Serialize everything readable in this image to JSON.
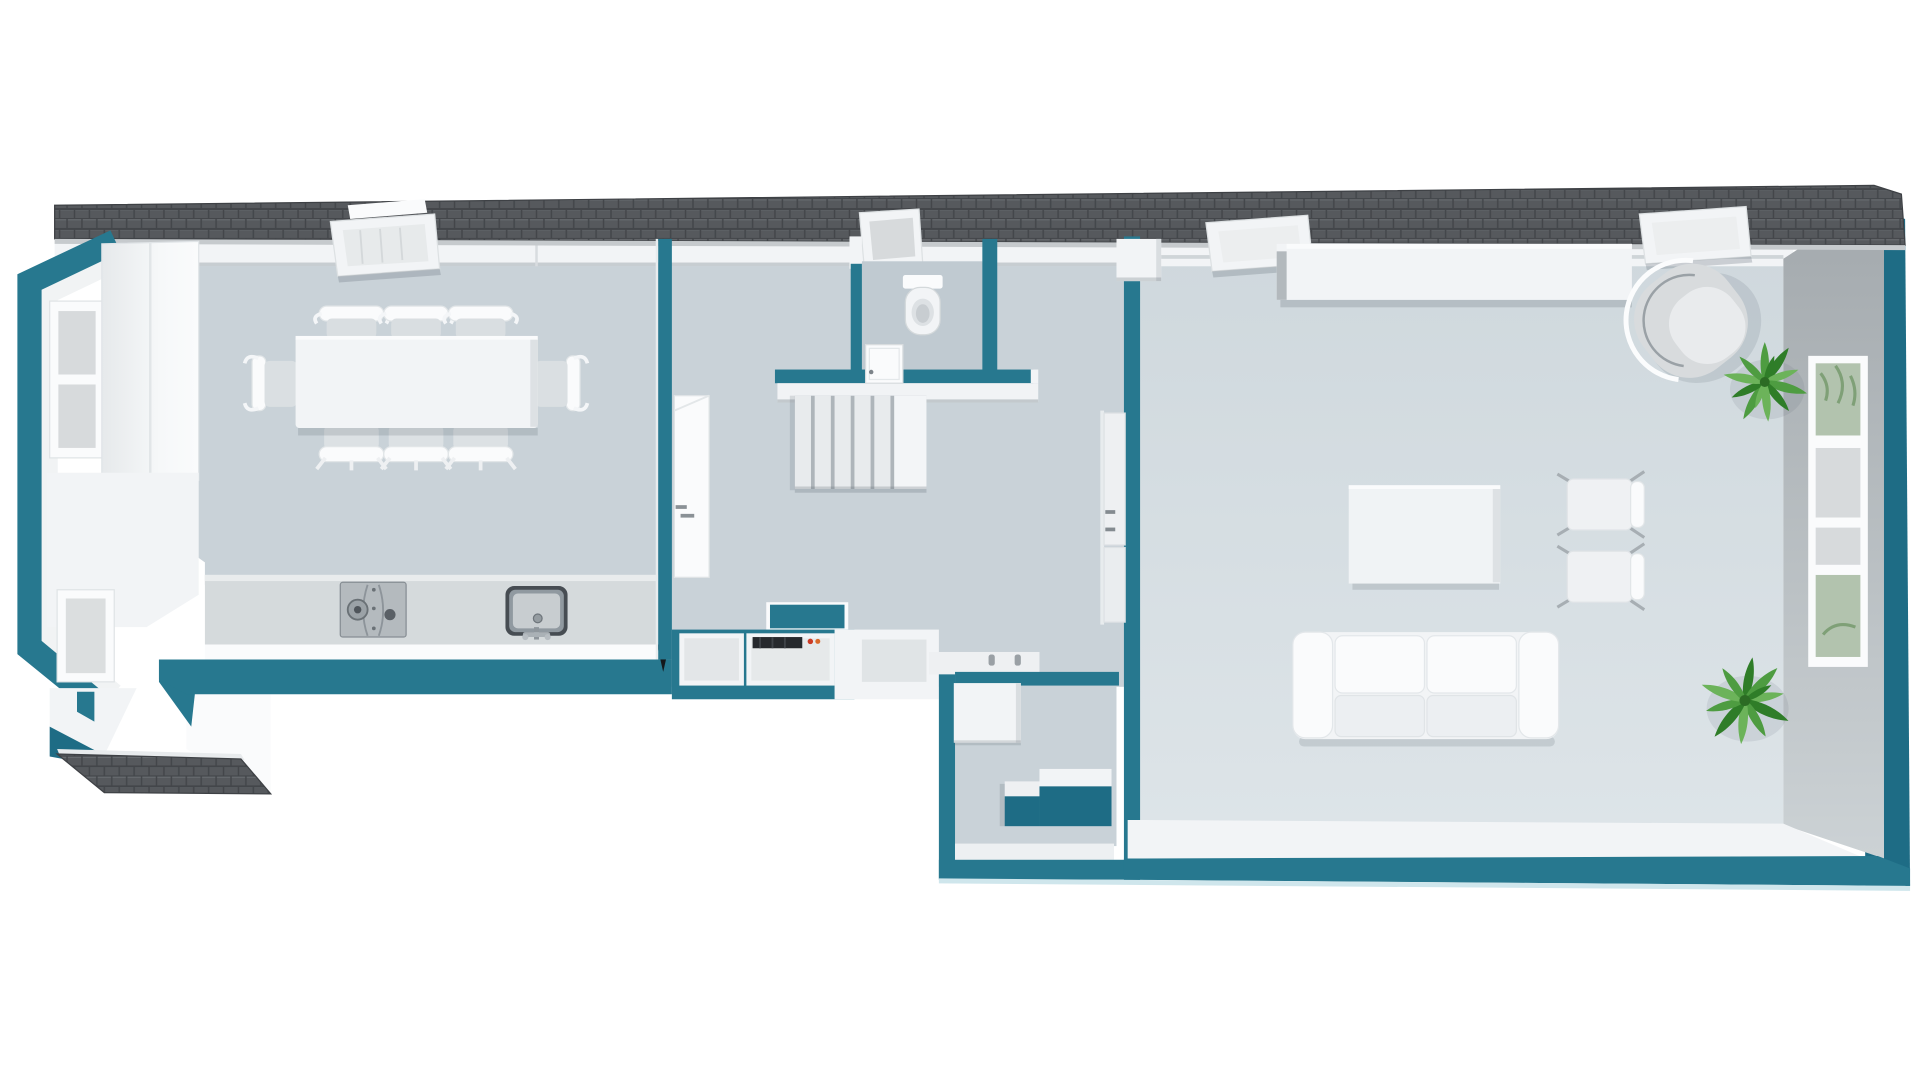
{
  "meta": {
    "title": "3D floor plan render, top-down view of a single-storey flat",
    "render_style": "white furniture, teal cut walls, tiled grey roof strip, white background"
  },
  "colors": {
    "teal": "#27788f",
    "teal_dark": "#1e6c85",
    "teal_pale": "#cfe6ec",
    "roof": "#56595d",
    "roof_line": "#43464a",
    "roof_hi": "#696d71",
    "floor": "#c9d2d8",
    "floor_dark": "#c0cad1",
    "floor_living_top": "#cfd8dd",
    "floor_living_bot": "#dde4e8",
    "white": "#f2f4f6",
    "white_hi": "#fafbfc",
    "shade": "#d9dde0",
    "gray_edge": "#b4bac0",
    "gray_face_top": "#a3a9ad",
    "gray_face_bot": "#ccd2d5",
    "pane": "#d7dadc",
    "pane_green": "#b2c3ae",
    "steel_dark": "#474d53",
    "steel_mid": "#9099a0",
    "steel_light": "#c8cdd0",
    "appliance_dark": "#26292d",
    "accent_red": "#cc3b25",
    "accent_orange": "#d96a2c",
    "plant": "#4e9c41",
    "plant_dark": "#2f7d28",
    "plant_light": "#6cb35a"
  },
  "rooms": [
    {
      "id": "kitchen-dining",
      "label": "Kitchen / dining room",
      "furniture": [
        "dining table",
        "8 dining chairs",
        "kitchen counter",
        "gas cooktop",
        "sink",
        "tall cabinet",
        "bay windows"
      ]
    },
    {
      "id": "hallway",
      "label": "Hallway",
      "furniture": [
        "staircase with landing",
        "kitchenette nook with mini oven",
        "bench"
      ]
    },
    {
      "id": "bathroom",
      "label": "Bathroom",
      "furniture": [
        "toilet",
        "roof window",
        "door"
      ]
    },
    {
      "id": "entry",
      "label": "Entry vestibule",
      "furniture": [
        "closet",
        "two steps"
      ]
    },
    {
      "id": "living-room",
      "label": "Living room",
      "furniture": [
        "sideboard",
        "armchair",
        "coffee table",
        "2 side chairs",
        "2-seat sofa",
        "2 plants",
        "tall window",
        "chimney block"
      ]
    }
  ],
  "features": {
    "skylights": 3,
    "roof": "dark tiled roof strip along the whole top edge",
    "porch": "small tiled porch roof at the lower-left corner",
    "doors": [
      "kitchen-hall door",
      "bathroom door",
      "living room double door"
    ]
  }
}
